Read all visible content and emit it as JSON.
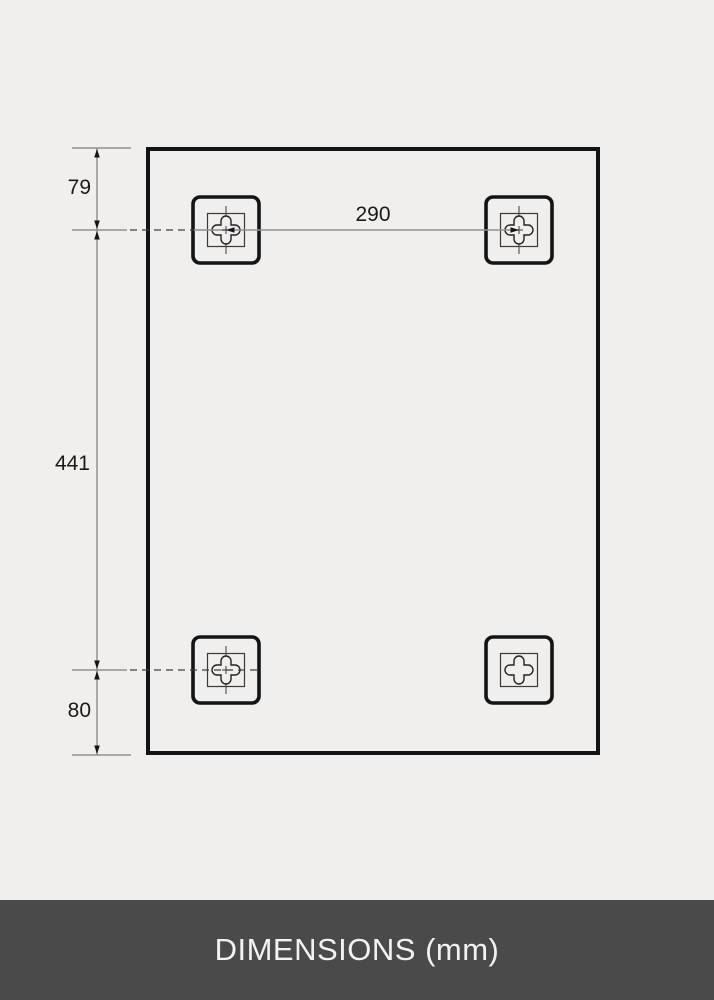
{
  "diagram": {
    "dimensions": {
      "top_offset": "79",
      "vertical_span": "441",
      "bottom_offset": "80",
      "horizontal_span": "290"
    }
  },
  "footer": {
    "label": "DIMENSIONS (mm)"
  },
  "colors": {
    "background": "#f1efed",
    "outline": "#141414",
    "dimension_line": "#909090",
    "dashed_line": "#3f3f3f",
    "label_text": "#1a1a1a",
    "footer_background": "#4a4a4a",
    "footer_text": "#f3f2f0"
  }
}
